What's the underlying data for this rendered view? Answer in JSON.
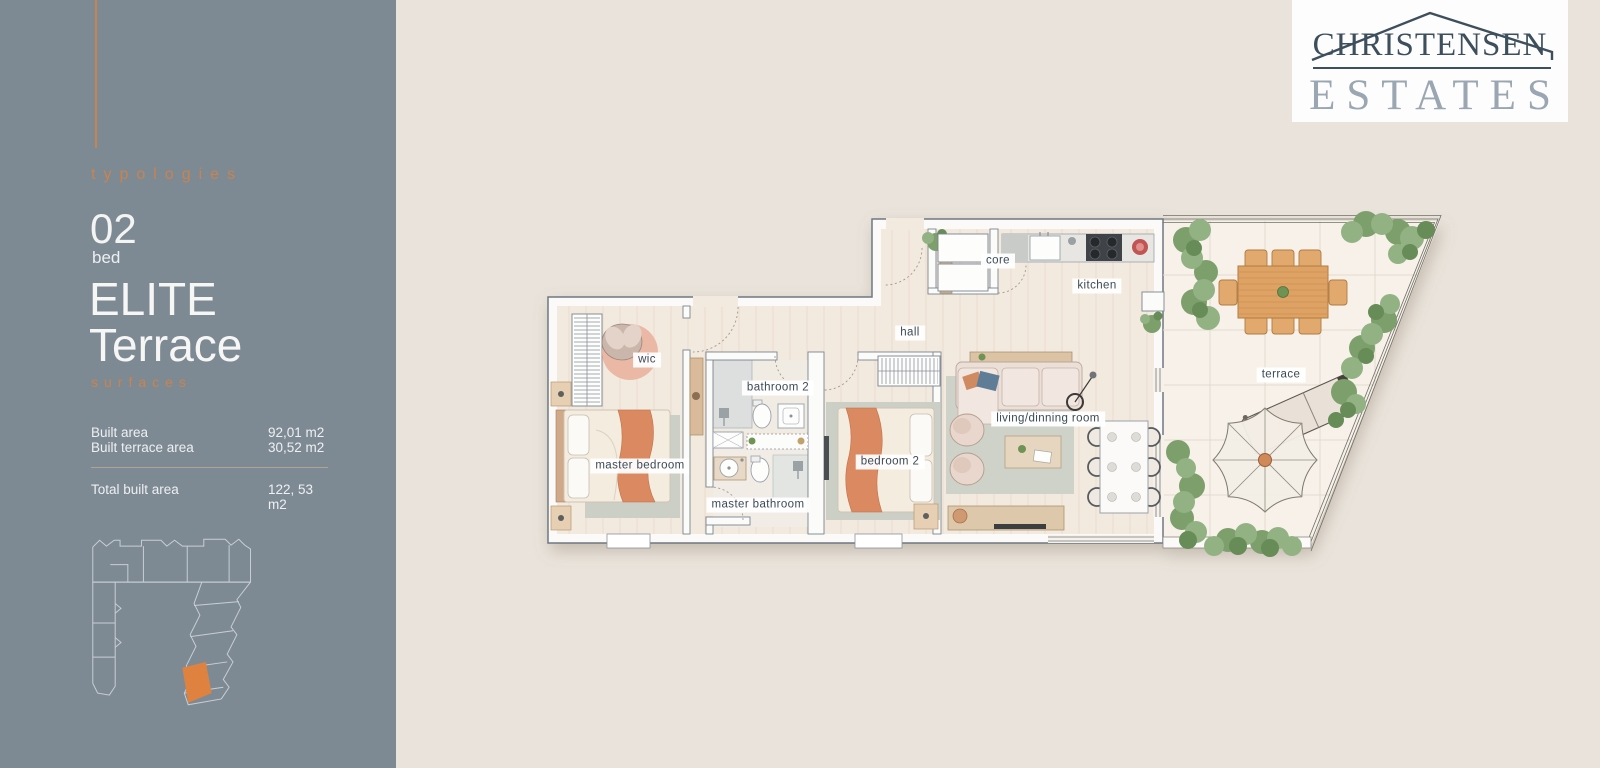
{
  "brand": {
    "line1": "CHRISTENSEN",
    "line2": "ESTATES"
  },
  "sidebar": {
    "kicker": "typologies",
    "bedrooms_number": "02",
    "bedrooms_unit": "bed",
    "type_name_line1": "ELITE",
    "type_name_line2": "Terrace",
    "surfaces_kicker": "surfaces",
    "rows": [
      {
        "label": "Built area",
        "value": "92,01 m2"
      },
      {
        "label": "Built terrace area",
        "value": "30,52 m2"
      }
    ],
    "total_label": "Total built area",
    "total_value": "122, 53 m2"
  },
  "plan": {
    "labels": [
      {
        "id": "core",
        "text": "core"
      },
      {
        "id": "kitchen",
        "text": "kitchen"
      },
      {
        "id": "hall",
        "text": "hall"
      },
      {
        "id": "wic",
        "text": "wic"
      },
      {
        "id": "bathroom-2",
        "text": "bathroom 2"
      },
      {
        "id": "master-bedroom",
        "text": "master bedroom"
      },
      {
        "id": "bedroom-2",
        "text": "bedroom 2"
      },
      {
        "id": "master-bathroom",
        "text": "master bathroom"
      },
      {
        "id": "living-dining",
        "text": "living/dinning room"
      },
      {
        "id": "terrace",
        "text": "terrace"
      }
    ]
  },
  "colors": {
    "sidebar_bg": "#7e8a93",
    "accent_orange": "#c9834f",
    "page_bg": "#e9e3db",
    "logo_navy": "#3d4f5c",
    "logo_gray": "#9aa6b1",
    "wall_stroke": "#6e7881",
    "wood_floor": "#f2e9df",
    "terrace_floor": "#f7f1e9",
    "throw_orange": "#db8960",
    "hedge_green": "#7c9f6c",
    "unit_highlight": "#e0823f"
  }
}
